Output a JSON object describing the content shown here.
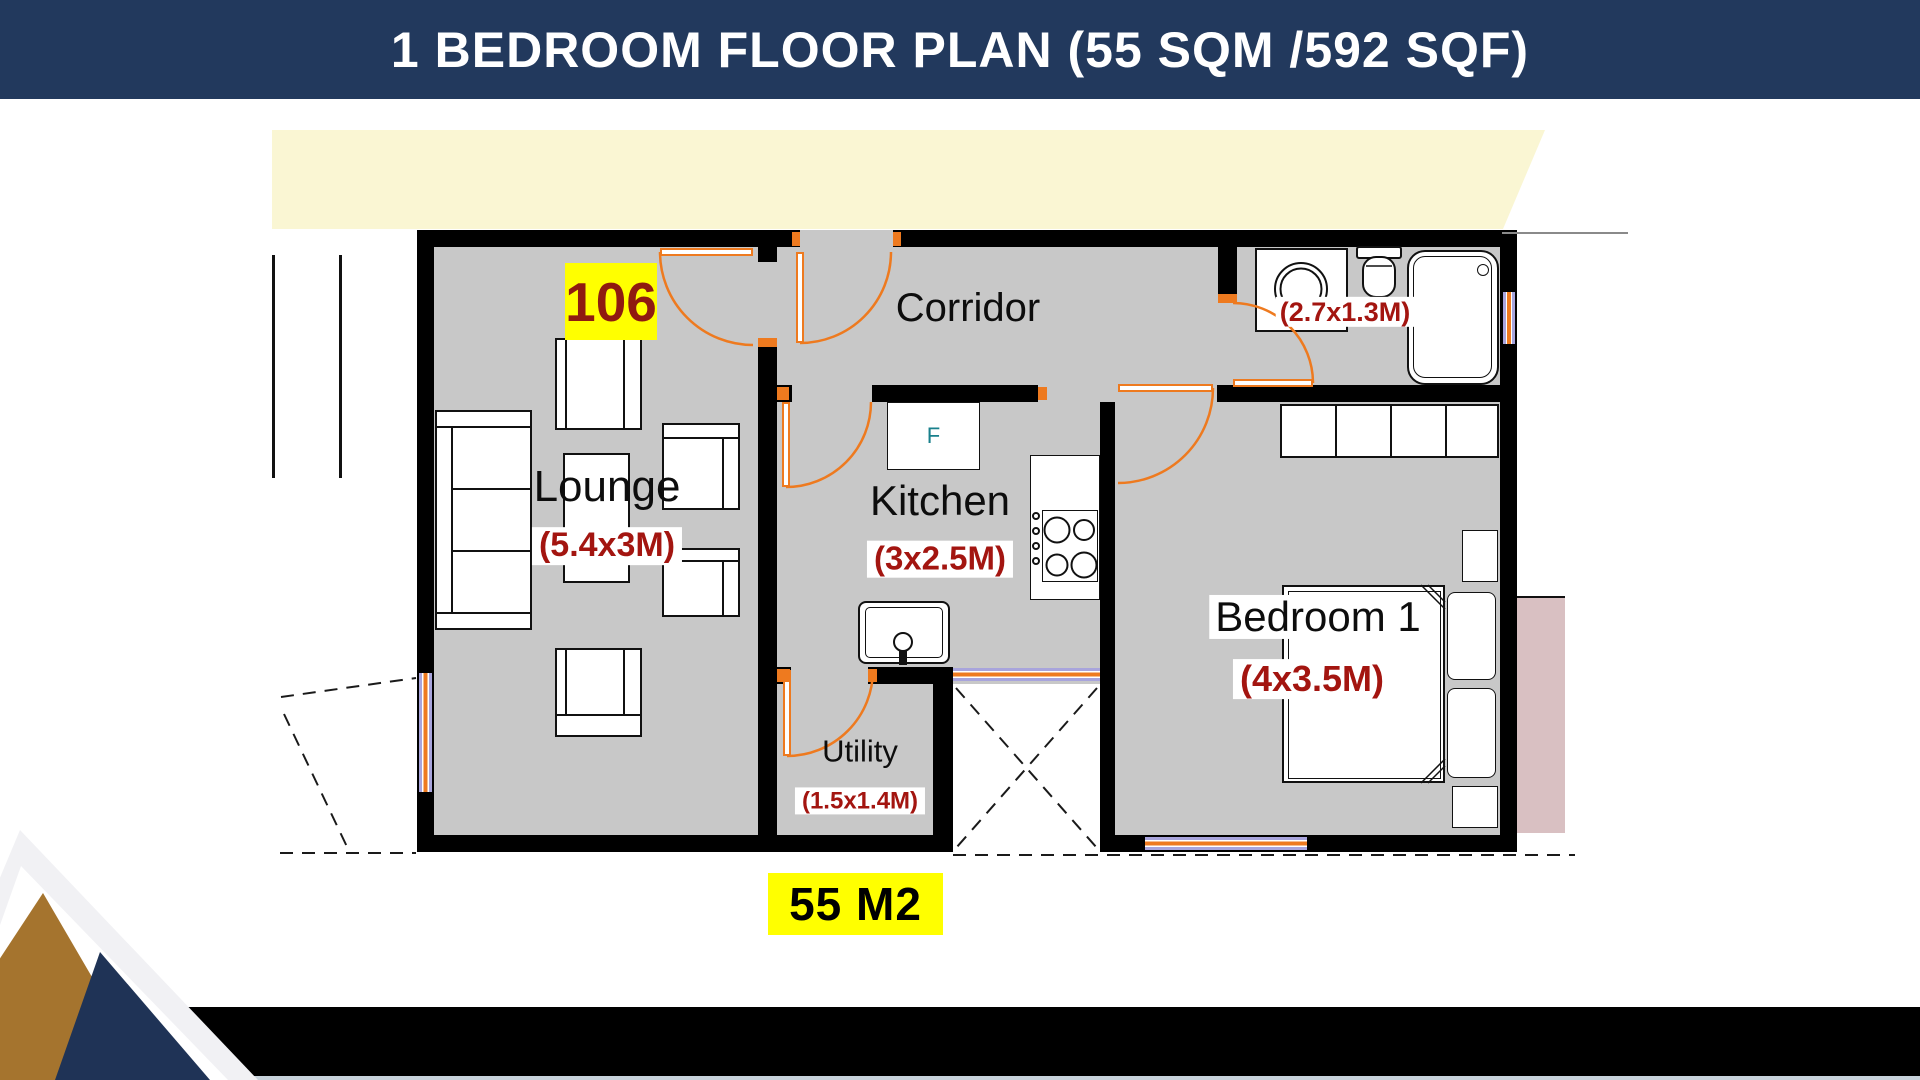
{
  "header": {
    "title": "1 BEDROOM FLOOR PLAN (55 SQM /592 SQF)"
  },
  "plan": {
    "unit_number": "106",
    "total_area": "55 M2",
    "rooms": {
      "corridor": {
        "name": "Corridor"
      },
      "lounge": {
        "name": "Lounge",
        "dims": "(5.4x3M)"
      },
      "kitchen": {
        "name": "Kitchen",
        "dims": "(3x2.5M)"
      },
      "utility": {
        "name": "Utility",
        "dims": "(1.5x1.4M)"
      },
      "bedroom": {
        "name": "Bedroom 1",
        "dims": "(4x3.5M)"
      },
      "bathroom": {
        "dims": "(2.7x1.3M)"
      }
    },
    "appliances": {
      "fridge_label": "F"
    }
  },
  "colors": {
    "header_bg": "#22395D",
    "floor_gray": "#C8C8C8",
    "wall_black": "#000000",
    "door_orange": "#EE7A1F",
    "window_lilac": "#A8A4DC",
    "dim_red": "#A31510",
    "unit_red": "#8F1B10",
    "highlight_yellow": "#FFFF00",
    "cream_band": "#FAF6D3",
    "fridge_teal": "#19808C",
    "logo_brown": "#A5742E",
    "logo_navy": "#1F3356",
    "balcony_pink": "#D9C0C2",
    "footer_black": "#000000"
  }
}
